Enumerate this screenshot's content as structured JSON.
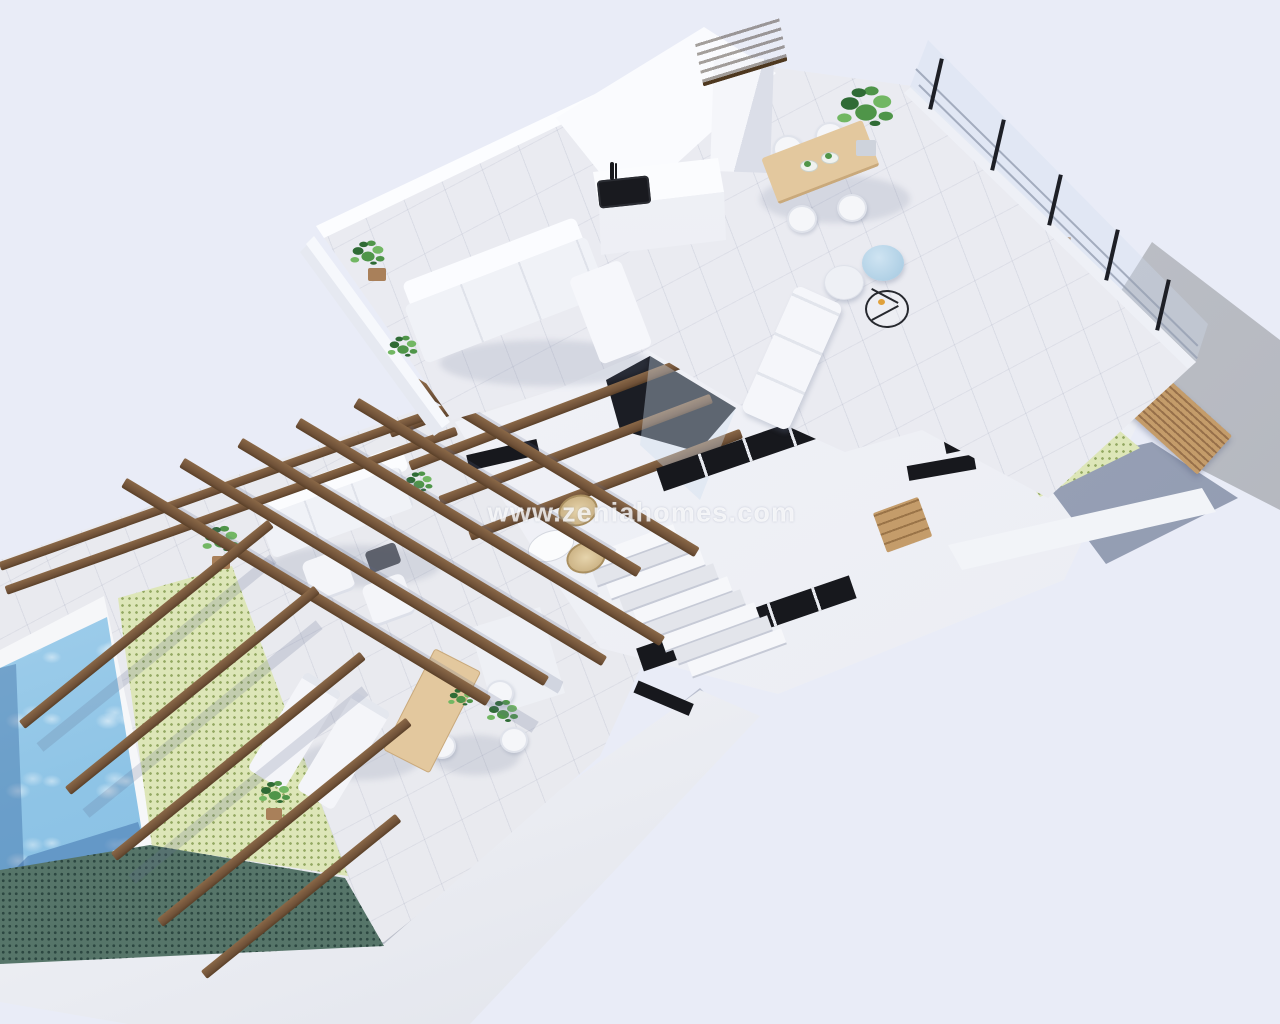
{
  "watermark": {
    "text": "www.zeniahomes.com"
  },
  "image": {
    "type": "3d-floorplan-cutaway-render",
    "subject": "villa upper floor with roof terrace, pergola terrace, courtyard and swimming pool"
  },
  "palette": {
    "bg": "#e9ecf7",
    "floor": "#e9eaef",
    "white": "#f3f4f8",
    "white_sun": "#fbfcfe",
    "white_shade": "#e2e5ee",
    "wood": "#7d5c3c",
    "wood_dark": "#5e452c",
    "wood_slat": "#bb905f",
    "wood_slat_dark": "#97704a",
    "wood_table": "#e3c89e",
    "wood_table_edge": "#c9a97b",
    "pool": "#8ec4e6",
    "pool_light": "#cfe9f8",
    "pool_deep": "#4d86c0",
    "green_tile": "#dde6b8",
    "green_dot": "#93a862",
    "teal_tile": "#567569",
    "teal_dot": "#2c4741",
    "concrete": "#bfc2c9",
    "concrete_dark": "#a7aab2",
    "dark": "#17181d",
    "glass": "#cfdded",
    "plant": "#4f9549",
    "plant_dark": "#2f6b35",
    "plant_light": "#72b763",
    "pot": "#a9805a",
    "pouf_blue": "#b7d6e8",
    "metal": "#23252b",
    "shadow": "#6b7694",
    "slate": "#9aa3b8",
    "wm": "rgba(255,255,255,0.78)"
  },
  "scene": {
    "rooftop_terrace": {
      "items": [
        "kitchen-counter",
        "black-sink",
        "chimney",
        "wood-dining-table",
        "four-white-chairs",
        "tall-potted-plant",
        "lounge-sofa",
        "blue-pouf",
        "white-pouf",
        "wire-side-table",
        "sun-chaise",
        "glass-cable-railing",
        "parapet-plants"
      ]
    },
    "mid_level": {
      "items": [
        "white-roof-slabs",
        "black-skylight-slots",
        "staircase",
        "bistro-table",
        "wicker-chairs",
        "glazed-void-with-beams"
      ]
    },
    "pergola_terrace": {
      "items": [
        "timber-pergola-beams",
        "outdoor-sofa",
        "two-armchairs",
        "coffee-table",
        "two-sun-loungers",
        "outdoor-wood-dining-table",
        "potted-plants"
      ]
    },
    "pool_area": {
      "items": [
        "swimming-pool",
        "white-coping",
        "green-mosaic-deck",
        "teal-mosaic-border",
        "pergola-beams"
      ]
    },
    "courtyard": {
      "items": [
        "green-mosaic-patio",
        "timber-slat-screen",
        "concrete-pad",
        "timber-steps",
        "shaded-patio-floor"
      ]
    }
  }
}
